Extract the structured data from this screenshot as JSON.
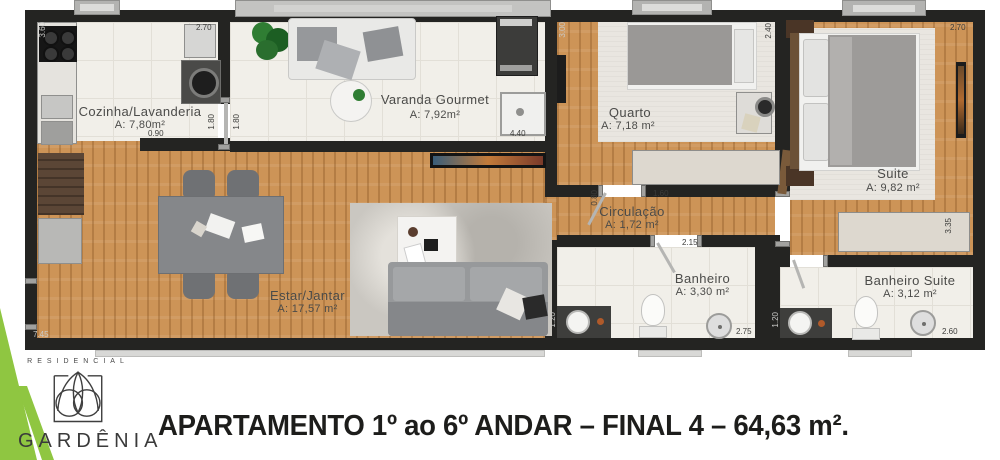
{
  "plan": {
    "rooms": {
      "cozinha": {
        "name": "Cozinha/Lavanderia",
        "area": "A: 7,80m²"
      },
      "varanda": {
        "name": "Varanda Gourmet",
        "area": "A: 7,92m²"
      },
      "quarto": {
        "name": "Quarto",
        "area": "A: 7,18 m²"
      },
      "suite": {
        "name": "Suite",
        "area": "A: 9,82 m²"
      },
      "circulacao": {
        "name": "Circulação",
        "area": "A: 1,72 m²"
      },
      "estar": {
        "name": "Estar/Jantar",
        "area": "A: 17,57 m²"
      },
      "banheiro": {
        "name": "Banheiro",
        "area": "A: 3,30 m²"
      },
      "banheiro_suite": {
        "name": "Banheiro Suite",
        "area": "A: 3,12 m²"
      }
    },
    "dimensions": {
      "kitchen_left": "3.60",
      "kitchen_top": "2.70",
      "kitchen_opening": "0.90",
      "laundry_a": "1.80",
      "laundry_b": "1.80",
      "varanda_w": "4.40",
      "quarto_left": "3.00",
      "quarto_right": "2.40",
      "suite_top": "2.70",
      "suite_side": "3.35",
      "circ_a": "0.80",
      "circ_b": "1.60",
      "circ_c": "2.15",
      "banheiro_w": "2.75",
      "banheiro_h": "1.20",
      "bsuite_w": "2.60",
      "bsuite_h": "1.20",
      "living_w": "7.45"
    }
  },
  "footer": {
    "brand_label": "RESIDENCIAL",
    "brand_name": "GARDÊNIA",
    "headline": "APARTAMENTO 1º ao 6º ANDAR – FINAL 4 – 64,63 m²."
  },
  "colors": {
    "wall": "#242422",
    "wood_floor": "#cd9457",
    "tile": "#f1efe9",
    "carpet": "#e9e6e0",
    "accent_green": "#8fc641",
    "text": "#1d1d1b"
  }
}
